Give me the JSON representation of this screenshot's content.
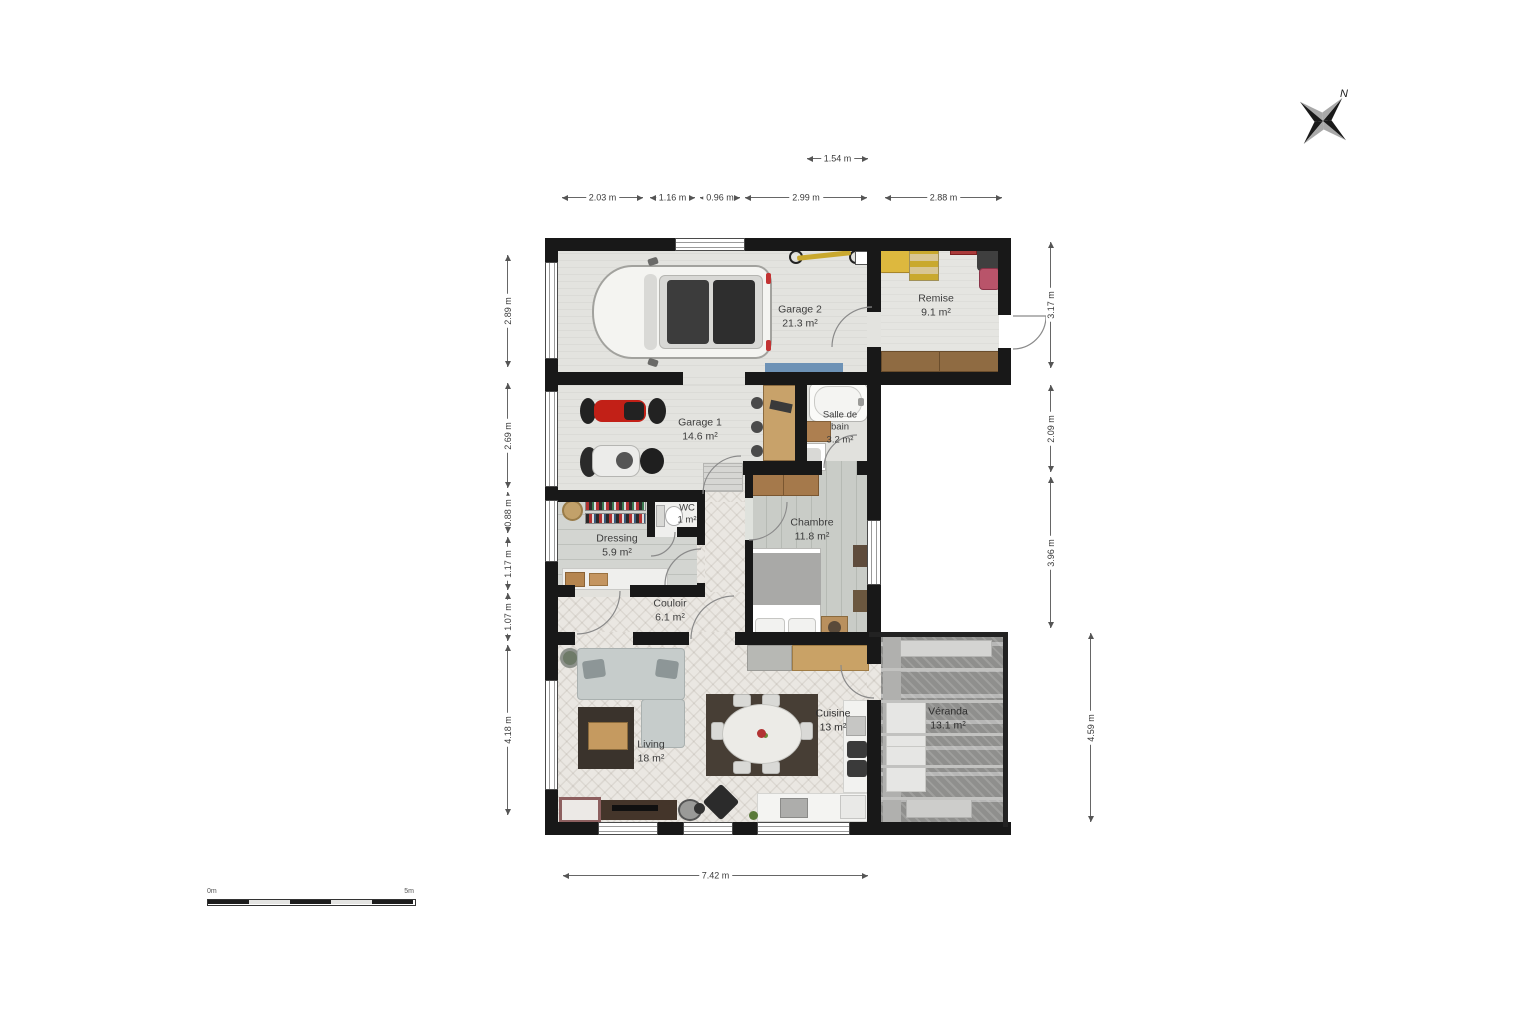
{
  "compass": {
    "north_label": "N"
  },
  "scale_bar": {
    "start_label": "0m",
    "end_label": "5m"
  },
  "rooms": {
    "garage2": {
      "name": "Garage 2",
      "area": "21.3 m²"
    },
    "remise": {
      "name": "Remise",
      "area": "9.1 m²"
    },
    "garage1": {
      "name": "Garage 1",
      "area": "14.6 m²"
    },
    "salle_de_bain": {
      "name": "Salle de bain",
      "area": "3.2 m²"
    },
    "wc": {
      "name": "WC",
      "area": "1 m²"
    },
    "dressing": {
      "name": "Dressing",
      "area": "5.9 m²"
    },
    "chambre": {
      "name": "Chambre",
      "area": "11.8 m²"
    },
    "couloir": {
      "name": "Couloir",
      "area": "6.1 m²"
    },
    "living": {
      "name": "Living",
      "area": "18 m²"
    },
    "cuisine": {
      "name": "Cuisine",
      "area": "13 m²"
    },
    "veranda": {
      "name": "Véranda",
      "area": "13.1 m²"
    }
  },
  "dimensions": {
    "top_inner": "1.54 m",
    "top": [
      "2.03 m",
      "1.16 m",
      "0.96 m",
      "2.99 m",
      "2.88 m"
    ],
    "left": [
      "2.89 m",
      "2.69 m",
      "0.88 m",
      "1.17 m",
      "1.07 m",
      "4.18 m"
    ],
    "right": [
      "3.17 m",
      "2.09 m",
      "3.96 m"
    ],
    "right_outer": "4.59 m",
    "bottom": "7.42 m"
  },
  "colors": {
    "wall": "#181818",
    "mat_blue": "#6d92b6",
    "moto_red": "#c22017",
    "equipment_yellow": "#ddb83e",
    "wood_brown": "#8f6b42"
  }
}
